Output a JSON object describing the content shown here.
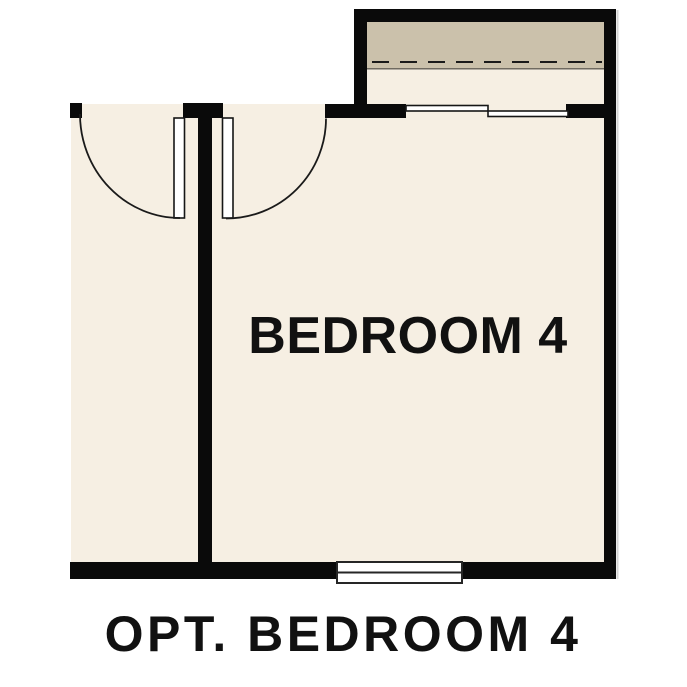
{
  "plan": {
    "room_label": "BEDROOM 4",
    "caption": "OPT. BEDROOM 4"
  },
  "colors": {
    "background": "#ffffff",
    "wall": "#0a0a0a",
    "floor": "#f6efe3",
    "bay_soffit": "#cbc1ab",
    "soffit_edge": "#6f6a60",
    "plan_line": "#1a1a1a",
    "window_fill": "#ffffff",
    "window_stroke": "#262626",
    "shadow": "#d4d4d4",
    "text": "#111111"
  }
}
